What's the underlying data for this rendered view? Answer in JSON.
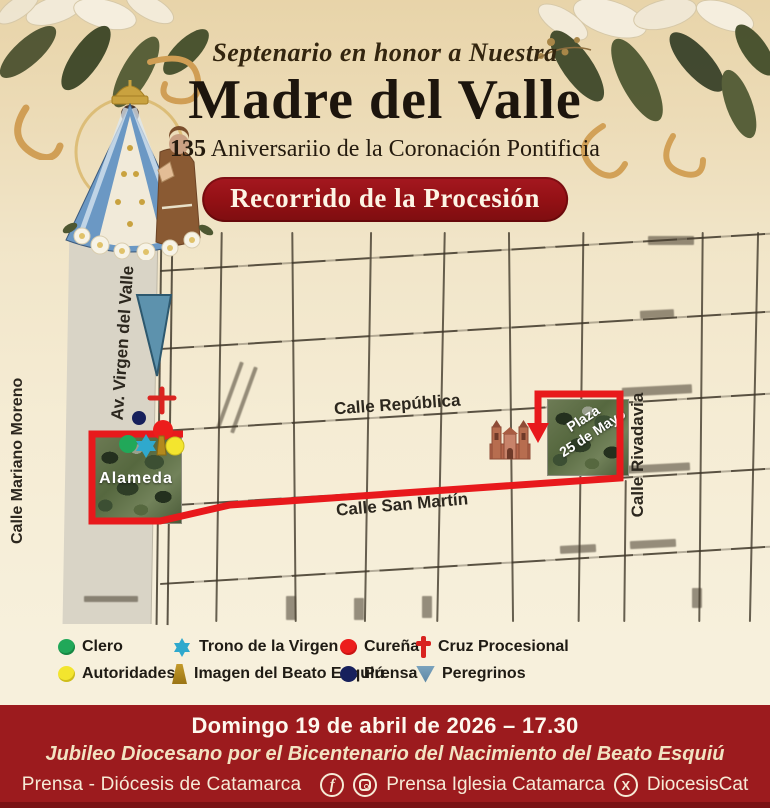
{
  "header": {
    "subtitle": "Septenario en honor a Nuestra",
    "title": "Madre del Valle",
    "anniversary_number": "135",
    "anniversary_text": " Aniversariio de la Coronación Pontificia",
    "badge": "Recorrido de la Procesión"
  },
  "map": {
    "streets": {
      "mariano_moreno": "Calle Mariano Moreno",
      "virgen_del_valle": "Av. Virgen del Valle",
      "republica": "Calle República",
      "san_martin": "Calle San Martín",
      "rivadavia": "Calle Rivadavia"
    },
    "places": {
      "alameda": "Alameda",
      "plaza_line1": "Plaza",
      "plaza_line2": "25 de Mayo"
    },
    "route_color": "#e8191c"
  },
  "legend": {
    "items": [
      {
        "label": "Clero",
        "marker": "green-dot",
        "color": "#21a859"
      },
      {
        "label": "Autoridades",
        "marker": "yellow-dot",
        "color": "#f3e52e"
      },
      {
        "label": "Trono de la Virgen",
        "marker": "teal-star",
        "color": "#2fa9cd"
      },
      {
        "label": "Imagen del Beato Esquiú",
        "marker": "gold-trapezoid",
        "color": "#b3891d"
      },
      {
        "label": "Cureña",
        "marker": "red-dot",
        "color": "#ec1d1c"
      },
      {
        "label": "Prensa",
        "marker": "navy-dot",
        "color": "#17205c"
      },
      {
        "label": "Cruz Procesional",
        "marker": "red-cross",
        "color": "#d8231f"
      },
      {
        "label": "Peregrinos",
        "marker": "blue-triangle",
        "color": "#6d98b5"
      }
    ]
  },
  "footer": {
    "date_line": "Domingo 19 de abril de 2026 – 17.30",
    "jubilee_line": "Jubileo Diocesano por el Bicentenario del Nacimiento del Beato Esquiú",
    "press_label": "Prensa - Diócesis de Catamarca",
    "social": {
      "facebook_letter": "f",
      "x_letter": "X",
      "handle_press": "Prensa Iglesia Catamarca",
      "handle_x": "DiocesisCat"
    }
  },
  "colors": {
    "banner_red": "#9c1b1e",
    "badge_red": "#921014",
    "route_red": "#e8191c",
    "cream_background": "#f5ecd4"
  }
}
